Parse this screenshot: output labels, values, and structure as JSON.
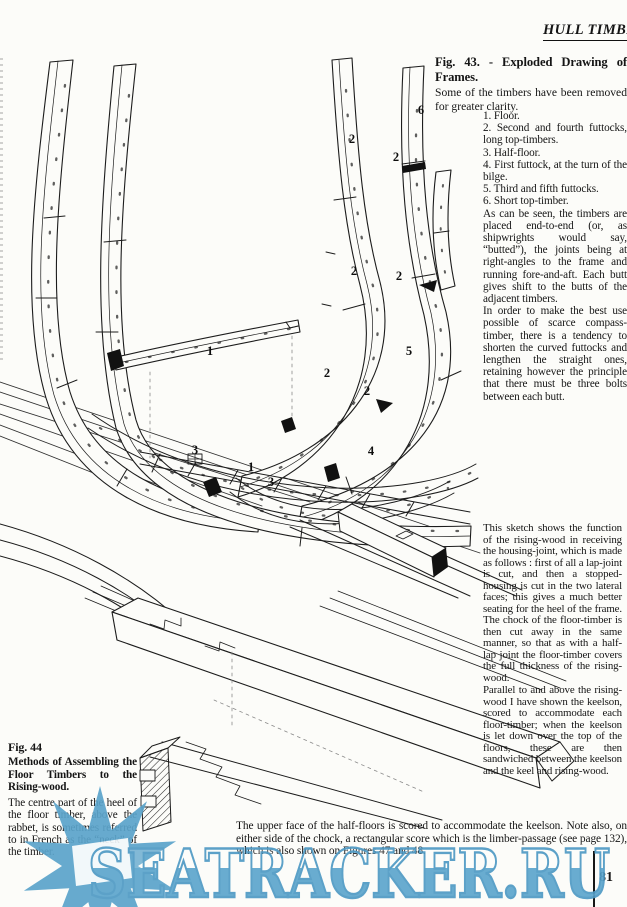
{
  "page": {
    "header": "HULL TIMBERS",
    "page_number": "81",
    "watermark": "SEATRACKER.RU"
  },
  "fig43": {
    "title": "Fig. 43. - Exploded Drawing of Frames.",
    "subtitle": "Some of the timbers have been removed for greater clarity.",
    "legend": [
      "1. Floor.",
      "2. Second and fourth futtocks, long top-timbers.",
      "3. Half-floor.",
      "4. First futtock, at the turn of the bilge.",
      "5. Third and fifth futtocks.",
      "6. Short top-timber."
    ],
    "para1": "As can be seen, the timbers are placed end-to-end (or, as shipwrights would say, “butted”), the joints being at right-angles to the frame and running fore-and-aft.  Each butt gives shift to the butts of the adjacent timbers.",
    "para2": "In order to make the best use possible of scarce compass-timber, there is a tendency to shorten the curved futtocks and lengthen the straight ones, retaining however the principle that there must be three bolts between each butt.",
    "labels": [
      {
        "text": "6",
        "x": 421,
        "y": 111
      },
      {
        "text": "2",
        "x": 352,
        "y": 140
      },
      {
        "text": "2",
        "x": 396,
        "y": 158
      },
      {
        "text": "2",
        "x": 354,
        "y": 272
      },
      {
        "text": "2",
        "x": 399,
        "y": 277
      },
      {
        "text": "1",
        "x": 210,
        "y": 352
      },
      {
        "text": "5",
        "x": 409,
        "y": 352
      },
      {
        "text": "2",
        "x": 327,
        "y": 374
      },
      {
        "text": "2",
        "x": 367,
        "y": 392
      },
      {
        "text": "3",
        "x": 195,
        "y": 451
      },
      {
        "text": "4",
        "x": 371,
        "y": 452
      },
      {
        "text": "1",
        "x": 251,
        "y": 468
      },
      {
        "text": "3",
        "x": 271,
        "y": 483
      }
    ]
  },
  "sketch_note": {
    "para1": "This sketch shows the function of the rising-wood in receiving the housing-joint, which is made as follows : first of all a lap-joint is cut, and then a stopped-housing is cut in the two lateral faces; this gives a much better seating for the heel of the frame.  The chock of the floor-timber is then cut away in the same manner, so that as with a half-lap joint the floor-timber covers the full thickness of the rising-wood.",
    "para2": "Parallel to and above the rising-wood I have shown the keelson, scored to accommodate each floor-timber; when the keelson is let down over the top of the floors, these are then sandwiched between the keelson and the keel and rising-wood."
  },
  "fig44": {
    "title": "Fig. 44",
    "heading": "Methods of Assembling the Floor Timbers to the Rising-wood.",
    "body": "The centre part of the heel of the floor timber, above the rabbet, is sometimes referred to in French as the “neck” of the timber."
  },
  "caption": {
    "text": "The upper face of the half-floors is scored to accommodate the keelson. Note also, on either side of the chock, a rectangular score which is the limber-passage (see page 132), which is also shown on Figures 47 and 48."
  }
}
